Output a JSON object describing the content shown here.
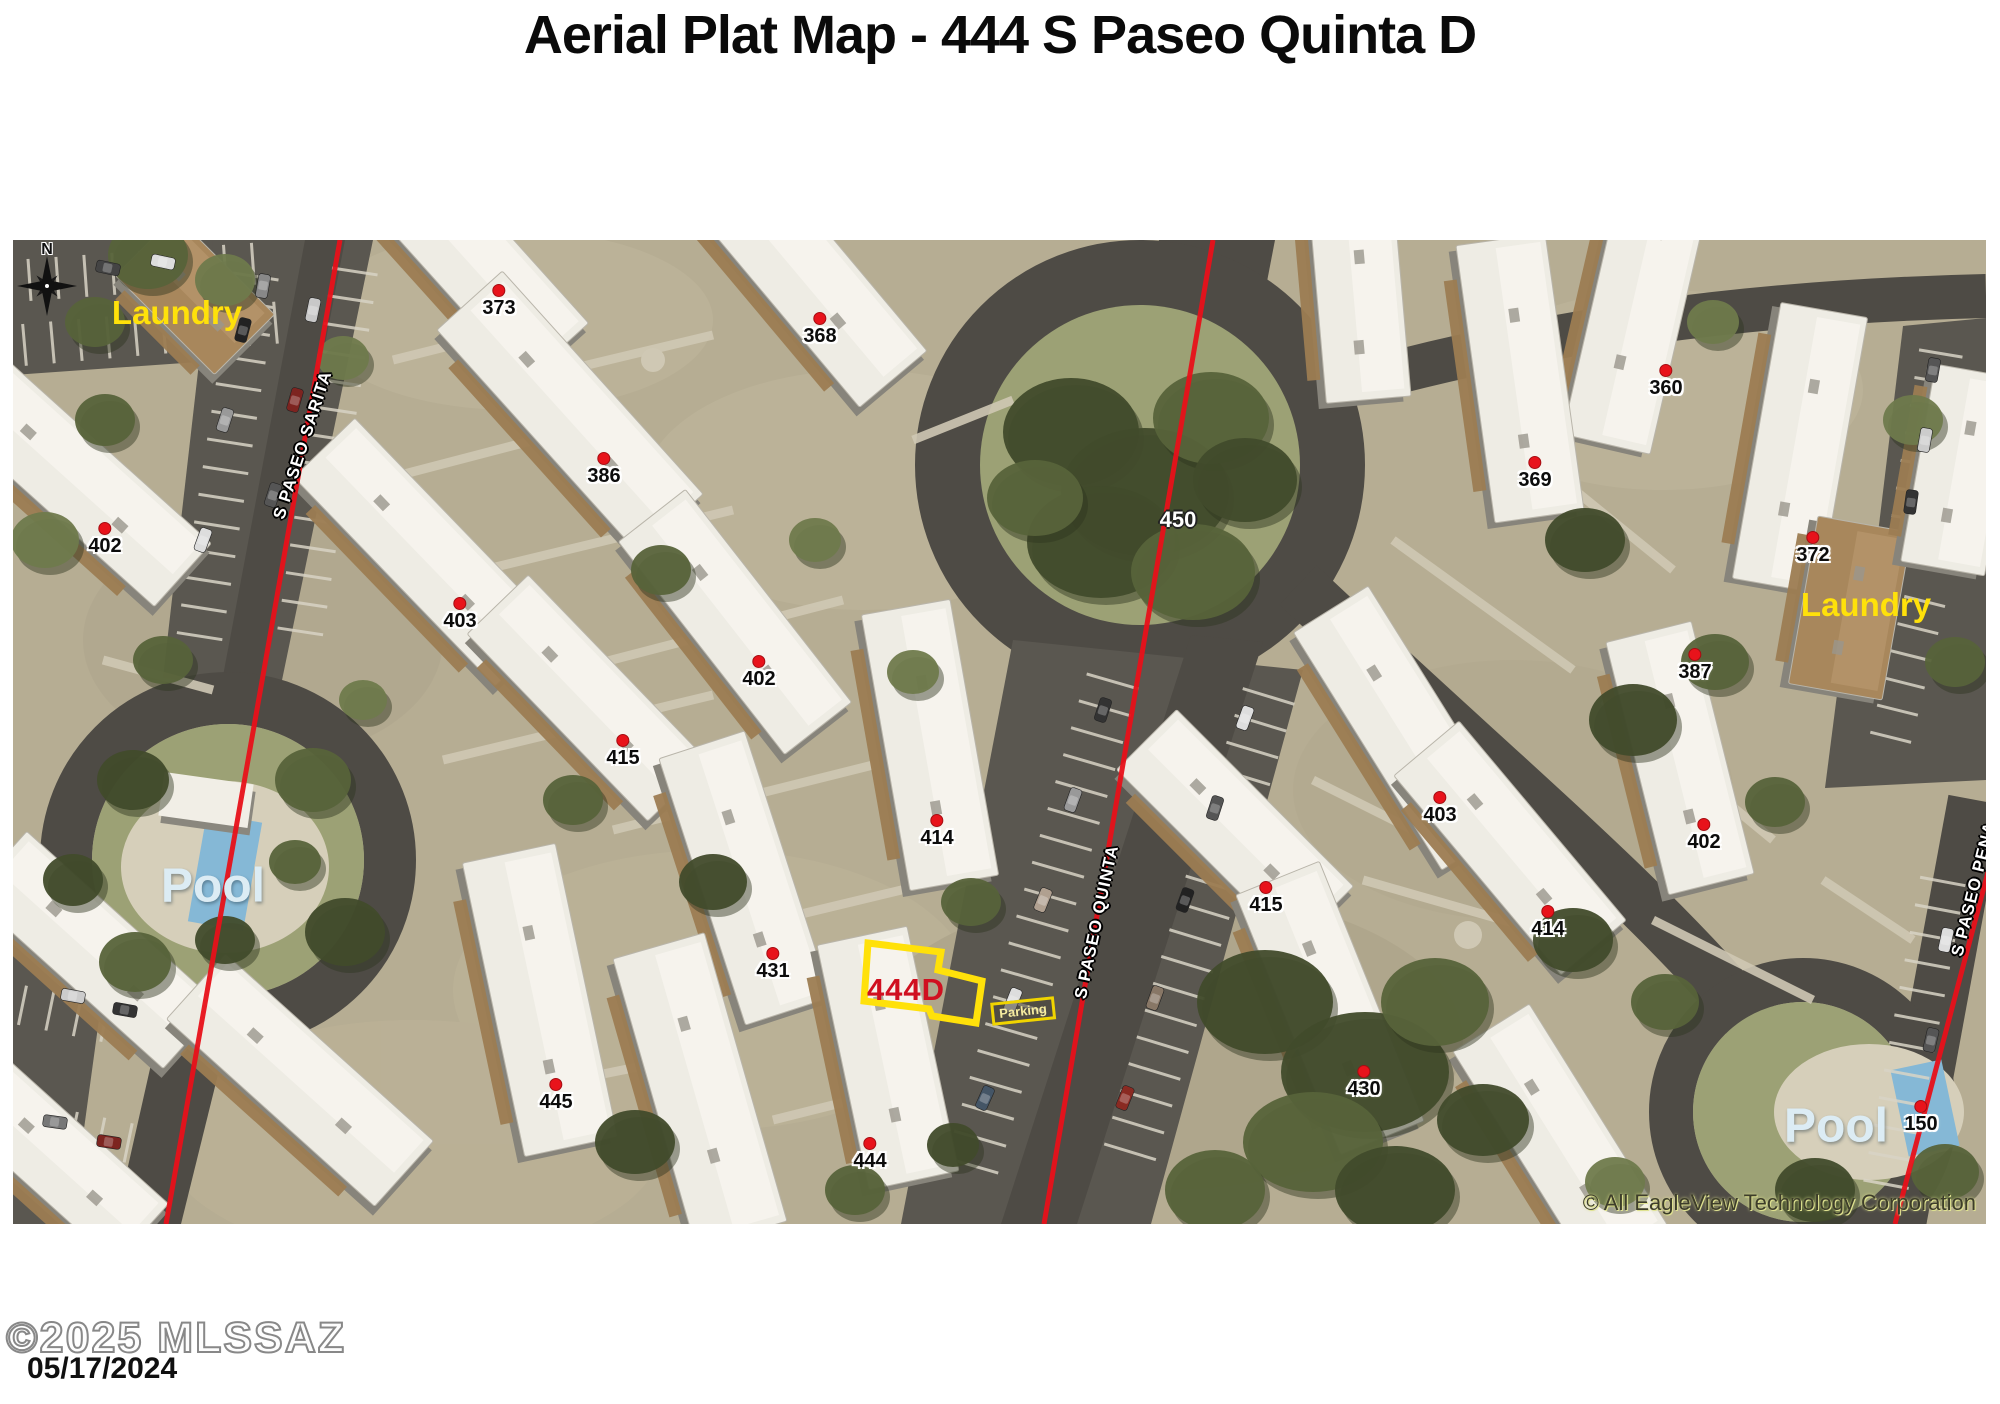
{
  "title": "Aerial Plat Map - 444 S Paseo Quinta D",
  "map": {
    "north_label": "N",
    "labels": {
      "laundry_left": {
        "text": "Laundry",
        "x": 164,
        "y": 73
      },
      "laundry_right": {
        "text": "Laundry",
        "x": 1853,
        "y": 365
      },
      "pool_left": {
        "text": "Pool",
        "x": 200,
        "y": 646
      },
      "pool_right": {
        "text": "Pool",
        "x": 1823,
        "y": 886
      },
      "circle_unit": {
        "text": "450",
        "x": 1165,
        "y": 280
      }
    },
    "streets": [
      {
        "name": "S PASEO SARITA",
        "x": 290,
        "y": 205,
        "rot": -72
      },
      {
        "name": "S PASEO QUINTA",
        "x": 1084,
        "y": 682,
        "rot": -78
      },
      {
        "name": "S PASEO PENA",
        "x": 1961,
        "y": 649,
        "rot": -76
      }
    ],
    "markers": [
      {
        "label": "373",
        "x": 486,
        "y": 50
      },
      {
        "label": "368",
        "x": 807,
        "y": 78
      },
      {
        "label": "386",
        "x": 591,
        "y": 218
      },
      {
        "label": "402",
        "x": 92,
        "y": 288
      },
      {
        "label": "403",
        "x": 447,
        "y": 363
      },
      {
        "label": "402",
        "x": 746,
        "y": 421
      },
      {
        "label": "415",
        "x": 610,
        "y": 500
      },
      {
        "label": "414",
        "x": 924,
        "y": 580
      },
      {
        "label": "431",
        "x": 760,
        "y": 713
      },
      {
        "label": "445",
        "x": 543,
        "y": 844
      },
      {
        "label": "444",
        "x": 857,
        "y": 903
      },
      {
        "label": "360",
        "x": 1653,
        "y": 130
      },
      {
        "label": "369",
        "x": 1522,
        "y": 222
      },
      {
        "label": "372",
        "x": 1800,
        "y": 297
      },
      {
        "label": "387",
        "x": 1682,
        "y": 414
      },
      {
        "label": "403",
        "x": 1427,
        "y": 557
      },
      {
        "label": "402",
        "x": 1691,
        "y": 584
      },
      {
        "label": "415",
        "x": 1253,
        "y": 647
      },
      {
        "label": "414",
        "x": 1535,
        "y": 671
      },
      {
        "label": "430",
        "x": 1351,
        "y": 831
      },
      {
        "label": "150",
        "x": 1908,
        "y": 866
      }
    ],
    "highlight": {
      "parcel_label": "444D",
      "x": 893,
      "y": 750,
      "parking_label": "Parking",
      "px": 1010,
      "py": 771
    },
    "credit": "© All EagleView Technology Corporation"
  },
  "footer": {
    "watermark": "©2025 MLSSAZ",
    "date": "05/17/2024"
  }
}
